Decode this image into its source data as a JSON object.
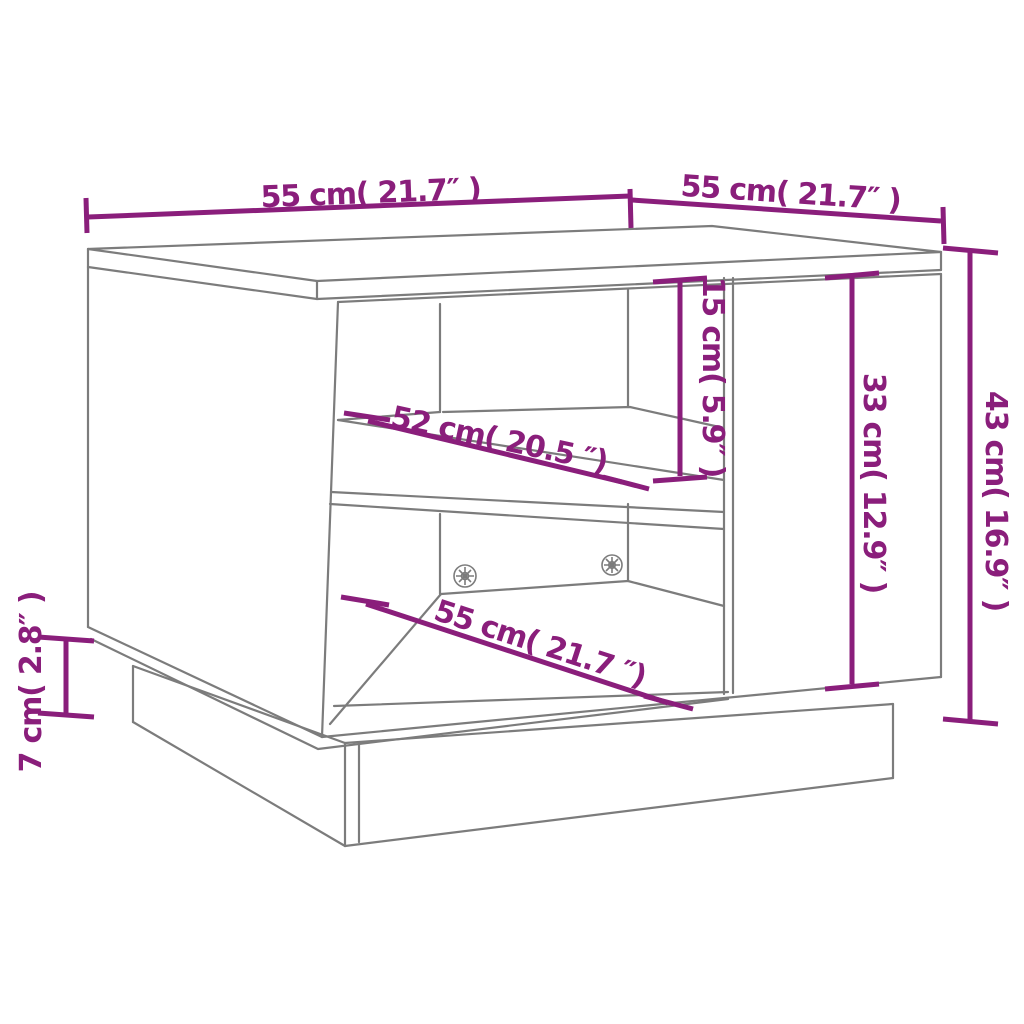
{
  "diagram": {
    "type": "furniture-dimension-diagram",
    "colors": {
      "accent": "#8a1e7b",
      "line": "#7c7c7c",
      "background": "#ffffff"
    },
    "dimensions": [
      {
        "id": "tabletop-width-left",
        "label": "55 cm( 21.7″ )",
        "cm": 55,
        "inches": 21.7,
        "orientation": "horizontal-top-left"
      },
      {
        "id": "tabletop-depth-right",
        "label": "55 cm( 21.7″ )",
        "cm": 55,
        "inches": 21.7,
        "orientation": "horizontal-top-right"
      },
      {
        "id": "upper-compartment-height",
        "label": "15 cm( 5.9″ )",
        "cm": 15,
        "inches": 5.9,
        "orientation": "vertical"
      },
      {
        "id": "door-panel-height",
        "label": "33 cm( 12.9″ )",
        "cm": 33,
        "inches": 12.9,
        "orientation": "vertical"
      },
      {
        "id": "overall-height",
        "label": "43 cm( 16.9″ )",
        "cm": 43,
        "inches": 16.9,
        "orientation": "vertical-right"
      },
      {
        "id": "shelf-depth",
        "label": "52 cm( 20.5 ″)",
        "cm": 52,
        "inches": 20.5,
        "orientation": "diagonal"
      },
      {
        "id": "bottom-compartment-width",
        "label": "55 cm( 21.7 ″)",
        "cm": 55,
        "inches": 21.7,
        "orientation": "diagonal"
      },
      {
        "id": "base-plinth-height",
        "label": "7 cm( 2.8″ )",
        "cm": 7,
        "inches": 2.8,
        "orientation": "vertical-left"
      }
    ]
  }
}
